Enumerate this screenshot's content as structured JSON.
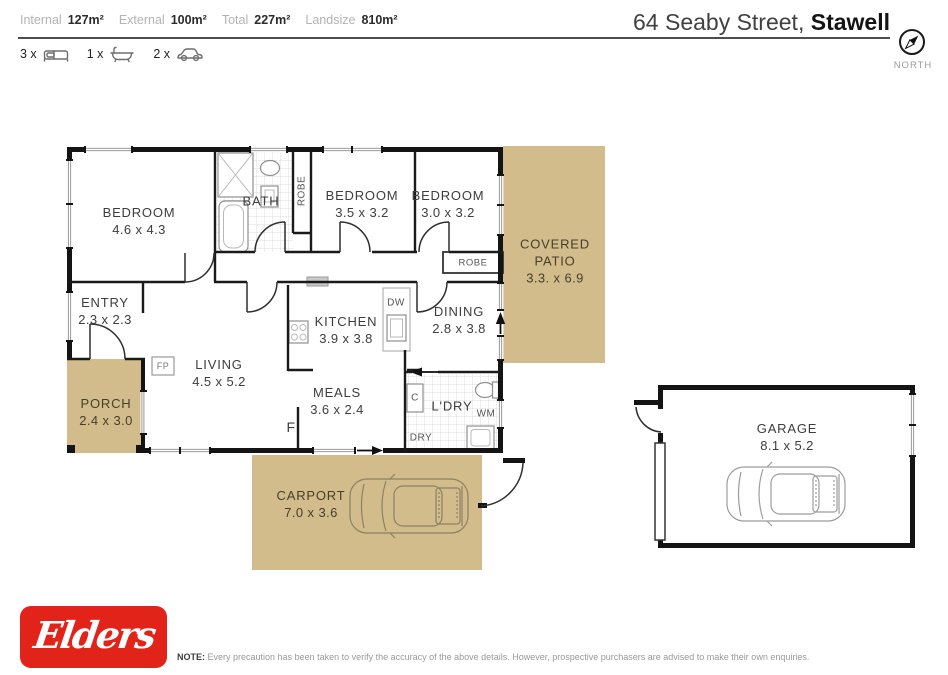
{
  "colors": {
    "tan": "#d2bc8b",
    "logo_red": "#e2231a",
    "wall": "#141414"
  },
  "header": {
    "stats": [
      {
        "label": "Internal",
        "value": "127m²"
      },
      {
        "label": "External",
        "value": "100m²"
      },
      {
        "label": "Total",
        "value": "227m²"
      },
      {
        "label": "Landsize",
        "value": "810m²"
      }
    ],
    "counts": [
      {
        "count": "3 x"
      },
      {
        "count": "1 x"
      },
      {
        "count": "2 x"
      }
    ],
    "title_regular": "64 Seaby Street,",
    "title_bold": "Stawell",
    "compass_label": "NORTH"
  },
  "plan": {
    "rooms": {
      "bedroom1": {
        "name": "BEDROOM",
        "dims": "4.6 x 4.3"
      },
      "bedroom2": {
        "name": "BEDROOM",
        "dims": "3.5 x 3.2"
      },
      "bedroom3": {
        "name": "BEDROOM",
        "dims": "3.0 x 3.2"
      },
      "bath": {
        "name": "BATH"
      },
      "entry": {
        "name": "ENTRY",
        "dims": "2.3 x 2.3"
      },
      "kitchen": {
        "name": "KITCHEN",
        "dims": "3.9 x 3.8"
      },
      "dining": {
        "name": "DINING",
        "dims": "2.8 x 3.8"
      },
      "living": {
        "name": "LIVING",
        "dims": "4.5 x 5.2"
      },
      "meals": {
        "name": "MEALS",
        "dims": "3.6 x 2.4"
      },
      "laundry": {
        "name": "L'DRY"
      },
      "porch": {
        "name": "PORCH",
        "dims": "2.4 x 3.0"
      },
      "carport": {
        "name": "CARPORT",
        "dims": "7.0 x 3.6"
      },
      "covered_patio": {
        "name": "COVERED",
        "name2": "PATIO",
        "dims": "3.3. x 6.9"
      },
      "garage": {
        "name": "GARAGE",
        "dims": "8.1 x 5.2"
      }
    },
    "labels": {
      "robe": "ROBE",
      "robe2": "ROBE",
      "dw": "DW",
      "c": "C",
      "dry": "DRY",
      "wm": "WM",
      "fridge": "F",
      "fireplace": "FP"
    }
  },
  "footer": {
    "logo_text": "Elders",
    "note_bold": "NOTE:",
    "note_text": "Every precaution has been taken to verify the accuracy of the above details. However, prospective purchasers are advised to make their own enquiries."
  }
}
